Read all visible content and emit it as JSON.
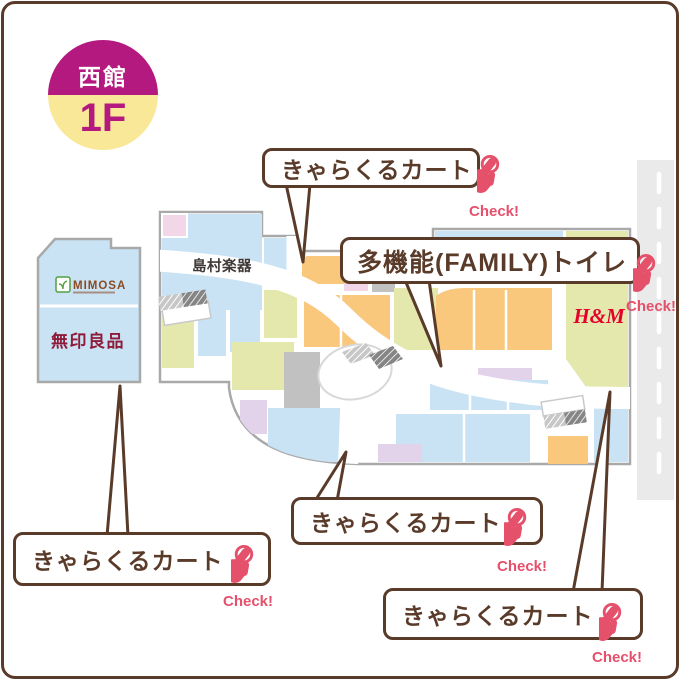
{
  "badge": {
    "building_label": "西館",
    "floor_label": "1F",
    "top_color": "#b3197e",
    "bottom_color": "#f9e897",
    "floor_text_color": "#b3197e"
  },
  "map": {
    "outline_color": "#a9a9a9",
    "road": {
      "color": "#eaeaea",
      "lane_line_color": "#ffffff"
    },
    "zone_colors": {
      "blue": "#c9e2f4",
      "orange": "#f9c87d",
      "green": "#e4e8ad",
      "lavender": "#e2d2ea",
      "pink": "#f2d7e8",
      "gray": "#c2c1c1"
    },
    "stores": {
      "mimosa": {
        "label": "MIMOSA",
        "color": "#8a4b22",
        "icon_color": "#52a044"
      },
      "muji": {
        "label": "無印良品",
        "color": "#8e1b38"
      },
      "shimamura": {
        "label": "島村楽器",
        "color": "#3f3a37"
      },
      "hm": {
        "label": "H&M",
        "color": "#e4002b"
      }
    }
  },
  "callouts": {
    "cart_top": {
      "label": "きゃらくるカート",
      "check_label": "Check!"
    },
    "family_toilet": {
      "label": "多機能(FAMILY)トイレ",
      "check_label": "Check!"
    },
    "cart_center": {
      "label": "きゃらくるカート",
      "check_label": "Check!"
    },
    "cart_left": {
      "label": "きゃらくるカート",
      "check_label": "Check!"
    },
    "cart_right": {
      "label": "きゃらくるカート",
      "check_label": "Check!"
    }
  },
  "accent": {
    "check_color": "#e5506b",
    "callout_border_color": "#5a3b2a"
  }
}
